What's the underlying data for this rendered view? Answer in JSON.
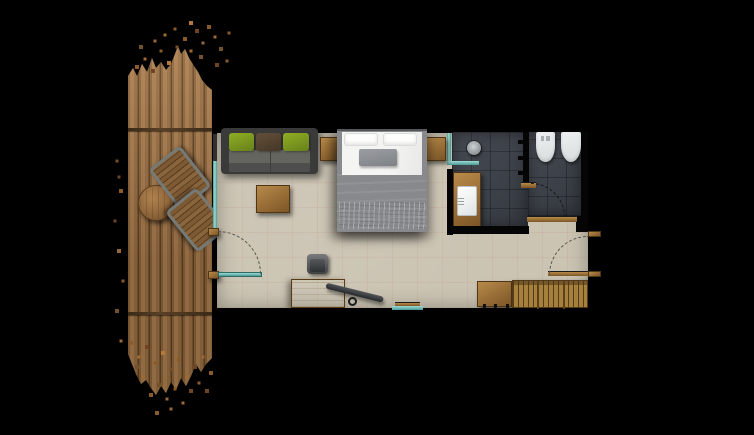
{
  "title": "Hotel room floor plan with terrace deck",
  "palette": {
    "bg": "#000000",
    "floor": "#cbc4b3",
    "floor_grid": "rgba(193,124,98,0.12)",
    "slate": "#3d424a",
    "grout": "rgba(10,12,16,0.35)",
    "glass": "#9adbd4",
    "glass_deep": "#4d9a94",
    "wood_light": "#b88a4a",
    "wood_dark": "#7c5526",
    "deck_light": "#a87b4e",
    "deck_mid": "#8a6339",
    "deck_dark": "#5e4124",
    "sofa_body": "#3a3a3a",
    "cushion_green": "#67811a",
    "cushion_brown": "#463626",
    "bed_white": "#f4f4f2",
    "bed_gray": "#87898c",
    "bed_throw": "#c2c4c6",
    "pillow_gray": "#7e8185",
    "fixture": "#eef1f1",
    "tv": "#26282b",
    "wall": "#050505",
    "arc_room": "#55554e",
    "arc_bath": "#15181b"
  },
  "legend": {
    "terrace": {
      "label": "Wooden terrace deck"
    },
    "deck_table": {
      "label": "Round deck table"
    },
    "deck_chair_a": {
      "label": "Deck chair"
    },
    "deck_chair_b": {
      "label": "Deck chair"
    },
    "glass_wall": {
      "label": "Glazed facade"
    },
    "terrace_door": {
      "label": "Terrace glass door"
    },
    "sofa": {
      "label": "Sofa with green and brown cushions"
    },
    "nightstand_left": {
      "label": "Nightstand"
    },
    "nightstand_right": {
      "label": "Nightstand"
    },
    "bed": {
      "label": "Double bed"
    },
    "coffee_table": {
      "label": "Coffee table"
    },
    "desk": {
      "label": "Writing desk"
    },
    "desk_chair": {
      "label": "Desk chair"
    },
    "tv_arm": {
      "label": "Swivel TV arm"
    },
    "low_window": {
      "label": "Low window"
    },
    "shower": {
      "label": "Walk-in shower with floor drain"
    },
    "shower_glass": {
      "label": "Shower glass screen"
    },
    "vanity": {
      "label": "Vanity with washbasin"
    },
    "toilet": {
      "label": "Toilet"
    },
    "bidet": {
      "label": "Bidet"
    },
    "wc_door": {
      "label": "WC door swing"
    },
    "entry_door": {
      "label": "Entrance door swing"
    },
    "minibar": {
      "label": "Minibar cabinet"
    },
    "wardrobe": {
      "label": "Open wardrobe with hangers"
    }
  }
}
